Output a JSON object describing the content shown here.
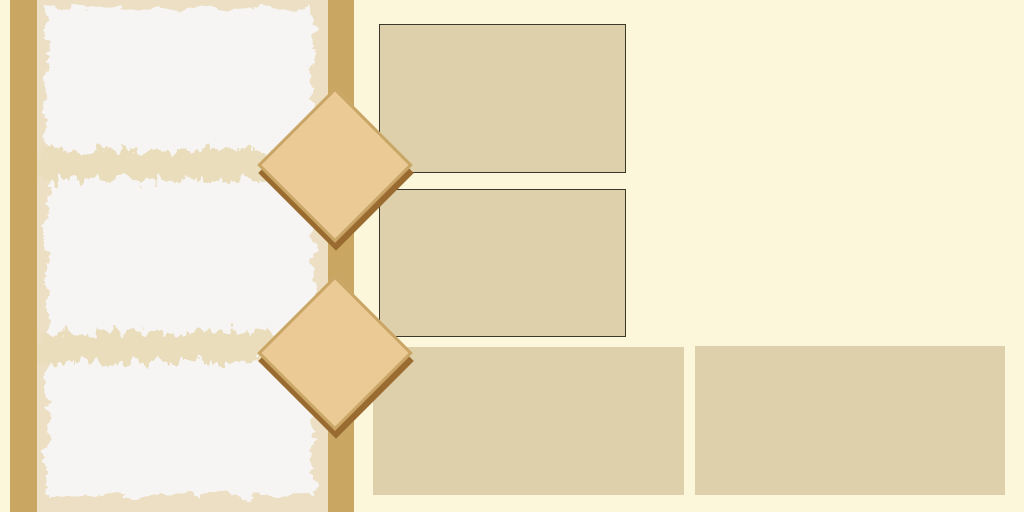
{
  "theme": {
    "colors": {
      "page-bg": "#fcf6da",
      "stripe": "#c9a763",
      "panel-beige": "#ecdfc3",
      "paper-white": "#f6f5f3",
      "paper-fleck": "#eaddbc",
      "diamond-fill": "#ecca96",
      "diamond-edge": "#c9a566",
      "diamond-shadow": "#9a6b31",
      "card-fill": "#ded0ab",
      "card-border": "#3a372b"
    }
  },
  "decor": {
    "diamond_count": 2,
    "card_count": 4,
    "bordered_card_count": 2,
    "paper_section_count": 3
  }
}
